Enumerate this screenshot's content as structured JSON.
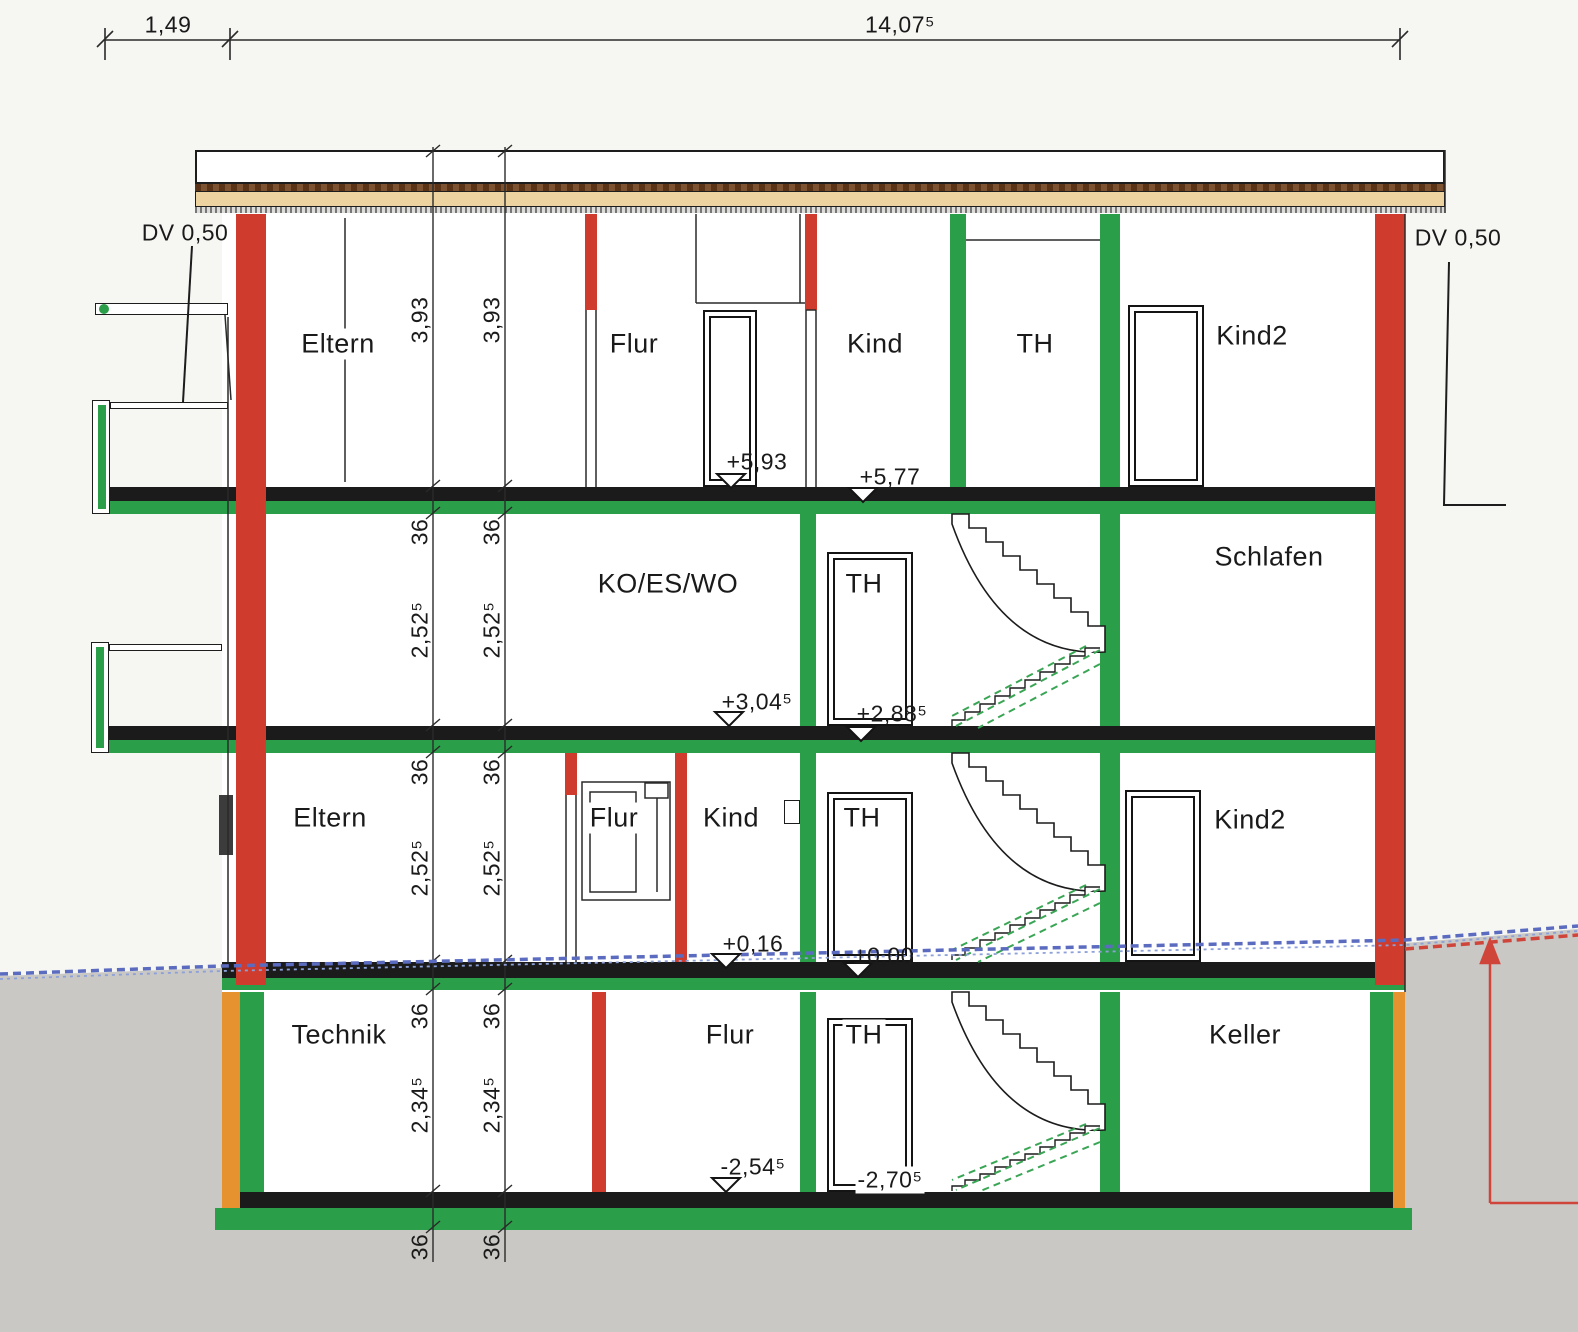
{
  "top_dimensions": {
    "left": "1,49",
    "main": "14,07⁵"
  },
  "roof_annotations": {
    "dv_left": "DV 0,50",
    "dv_right": "DV 0,50"
  },
  "floors": {
    "og2": {
      "eltern": "Eltern",
      "flur": "Flur",
      "kind": "Kind",
      "th": "TH",
      "kind2": "Kind2"
    },
    "og1": {
      "living": "KO/ES/WO",
      "th": "TH",
      "schlafen": "Schlafen"
    },
    "eg": {
      "eltern": "Eltern",
      "flur": "Flur",
      "kind": "Kind",
      "th": "TH",
      "kind2": "Kind2"
    },
    "kg": {
      "technik": "Technik",
      "flur": "Flur",
      "th": "TH",
      "keller": "Keller"
    }
  },
  "elevation_markers": [
    {
      "id": "og2-floor",
      "label": "+5,93",
      "type": "open"
    },
    {
      "id": "og2-slab",
      "label": "+5,77",
      "type": "filled"
    },
    {
      "id": "og1-floor",
      "label": "+3,04⁵",
      "type": "open"
    },
    {
      "id": "og1-slab",
      "label": "+2,88⁵",
      "type": "filled"
    },
    {
      "id": "eg-floor",
      "label": "+0,16",
      "type": "open"
    },
    {
      "id": "eg-slab",
      "label": "±0,00",
      "type": "filled"
    },
    {
      "id": "kg-floor",
      "label": "-2,54⁵",
      "type": "open"
    },
    {
      "id": "kg-slab",
      "label": "-2,70⁵",
      "type": "open"
    }
  ],
  "vertical_dimensions": {
    "og2_height": "3,93",
    "slab_thickness": "36",
    "storey_height": "2,52⁵",
    "kg_height": "2,34⁵"
  },
  "colors": {
    "wall_red": "#cf3b2d",
    "wall_green": "#2b9e4a",
    "insulation_orange": "#e6932f",
    "roof_tan": "#edd3a0",
    "roof_brown": "#6e4526",
    "slab_black": "#1b1b1b",
    "terrain_blue": "#5b6cc0",
    "terrain_marker_red": "#d0453a",
    "earth_gray": "#c9c8c5"
  }
}
